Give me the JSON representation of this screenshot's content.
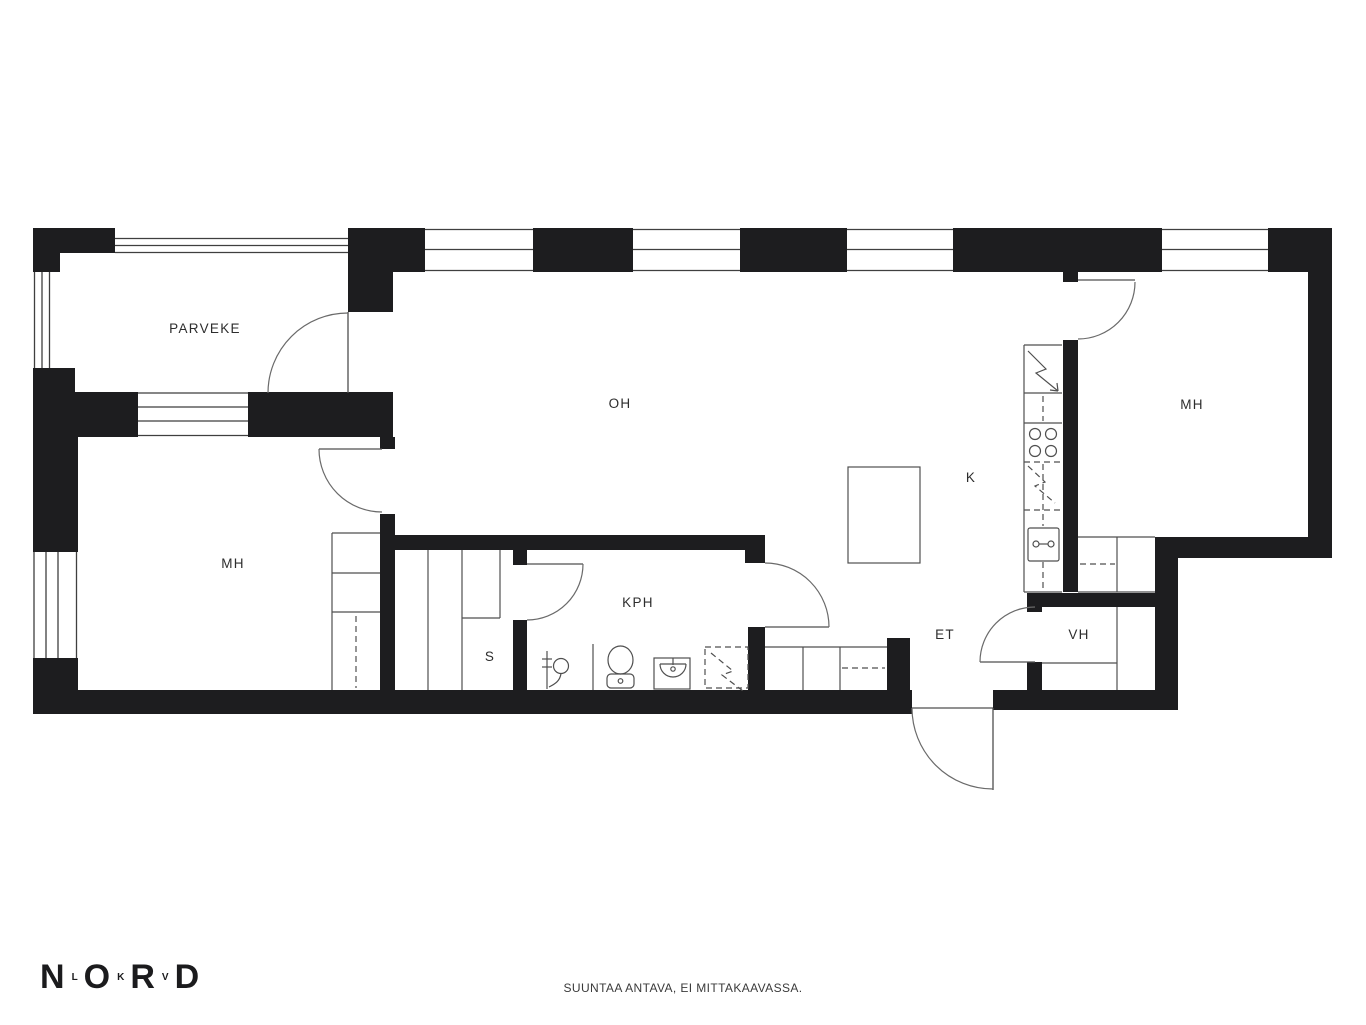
{
  "page": {
    "background": "#ffffff"
  },
  "plan": {
    "wall_color": "#1d1d1f",
    "line_color": "#4f4f4f",
    "label_color": "#2d2d2d",
    "rooms": {
      "parveke": "PARVEKE",
      "oh": "OH",
      "mh_left": "MH",
      "mh_right": "MH",
      "k": "K",
      "kph": "KPH",
      "s": "S",
      "et": "ET",
      "vh": "VH"
    },
    "fixtures": [
      "fridge",
      "stove",
      "kitchen-sink",
      "dishwasher-reservation",
      "dining-table",
      "toilet",
      "washbasin",
      "shower",
      "shower-screen",
      "washing-machine-reservation",
      "sauna-benches",
      "wardrobes",
      "hall-closets",
      "vh-shelves"
    ]
  },
  "logo": {
    "big1": "N",
    "small1": "L",
    "big2": "O",
    "small2": "K",
    "big3": "R",
    "small3": "V",
    "big4": "D"
  },
  "footer": {
    "disclaimer": "SUUNTAA ANTAVA, EI MITTAKAAVASSA."
  }
}
